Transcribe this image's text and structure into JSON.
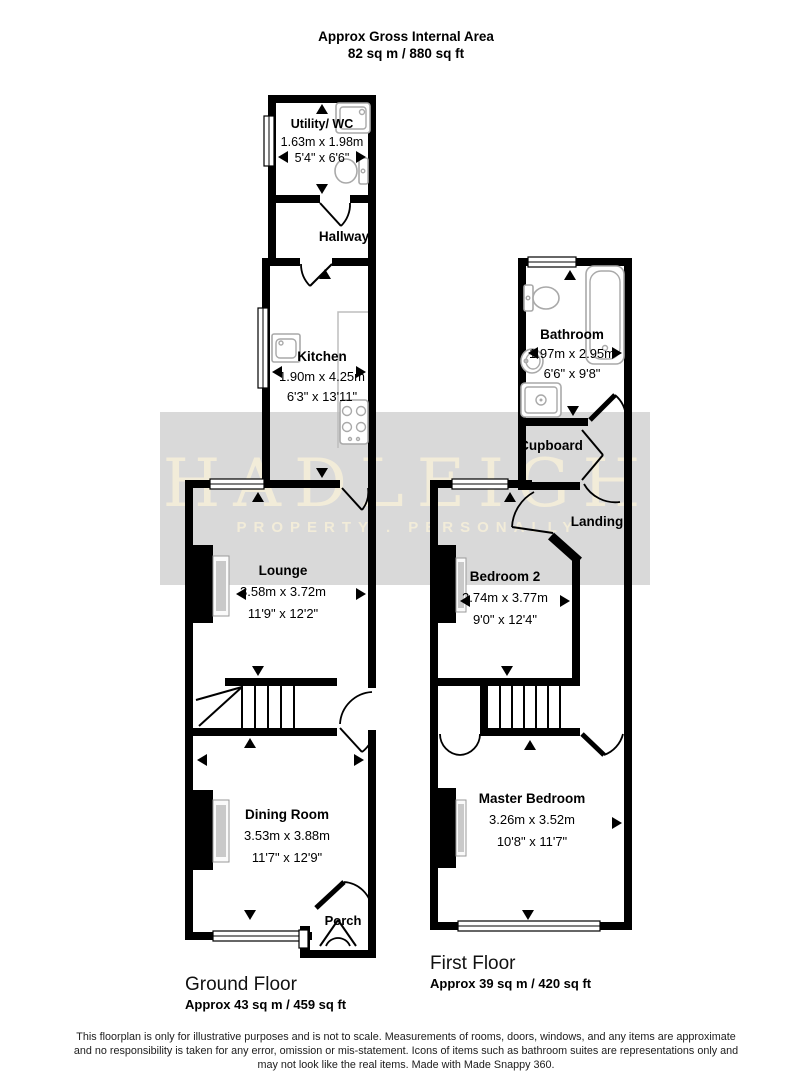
{
  "header": {
    "line1": "Approx Gross Internal Area",
    "line2": "82 sq m / 880 sq ft"
  },
  "watermark": {
    "title": "HADLEIGH",
    "subtitle": "PROPERTY . PERSONALLY",
    "band_color": "#d9d9d9",
    "text_color": "#f2ecd9"
  },
  "ground_floor": {
    "label": "Ground Floor",
    "area": "Approx 43 sq m / 459 sq ft",
    "rooms": {
      "utility": {
        "name": "Utility/ WC",
        "metric": "1.63m x 1.98m",
        "imperial": "5'4\" x 6'6\""
      },
      "hallway": {
        "name": "Hallway"
      },
      "kitchen": {
        "name": "Kitchen",
        "metric": "1.90m x 4.25m",
        "imperial": "6'3\" x 13'11\""
      },
      "lounge": {
        "name": "Lounge",
        "metric": "3.58m x 3.72m",
        "imperial": "11'9\" x 12'2\""
      },
      "dining": {
        "name": "Dining Room",
        "metric": "3.53m x 3.88m",
        "imperial": "11'7\" x 12'9\""
      },
      "porch": {
        "name": "Porch"
      }
    }
  },
  "first_floor": {
    "label": "First Floor",
    "area": "Approx 39 sq m / 420 sq ft",
    "rooms": {
      "bathroom": {
        "name": "Bathroom",
        "metric": "1.97m x 2.95m",
        "imperial": "6'6\" x 9'8\""
      },
      "cupboard": {
        "name": "Cupboard"
      },
      "landing": {
        "name": "Landing"
      },
      "bedroom2": {
        "name": "Bedroom 2",
        "metric": "2.74m x 3.77m",
        "imperial": "9'0\" x 12'4\""
      },
      "master": {
        "name": "Master Bedroom",
        "metric": "3.26m x 3.52m",
        "imperial": "10'8\" x 11'7\""
      }
    }
  },
  "footer": {
    "line1": "This floorplan is only for illustrative purposes and is not to scale. Measurements of rooms, doors, windows, and any items are approximate",
    "line2": "and no responsibility is taken for any error, omission or mis-statement. Icons of items such as bathroom suites are representations only and",
    "line3": "may not look like the real items. Made with Made Snappy 360."
  }
}
